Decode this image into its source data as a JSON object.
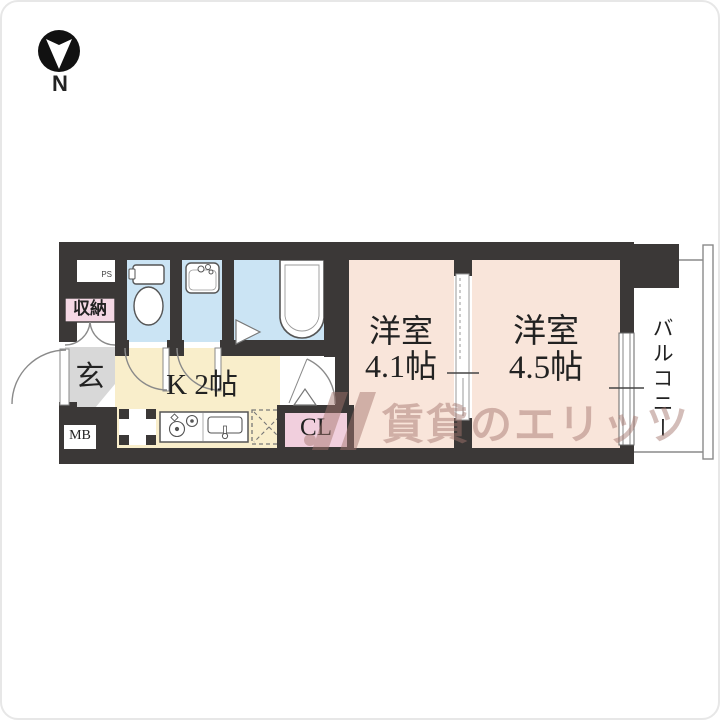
{
  "compass": {
    "north_label": "N"
  },
  "plan": {
    "rooms": {
      "pipe_space": "PS",
      "storage": "収納",
      "entrance": "玄",
      "meter_box": "MB",
      "kitchen": "K 2帖",
      "closet": "CL",
      "western_room_1": {
        "name": "洋室",
        "size": "4.1帖"
      },
      "western_room_2": {
        "name": "洋室",
        "size": "4.5帖"
      },
      "balcony": "バルコニー"
    },
    "colors": {
      "wall": "#3b3837",
      "floor_room": "#f9e5da",
      "floor_kitchen": "#f9eecb",
      "floor_wet": "#cbe4f4",
      "floor_entrance": "#d8d8d8",
      "label_pink_storage": "#f4d8e4",
      "label_pink_closet": "#f1cfdd",
      "balcony_floor": "#ffffff",
      "compass": "#111111",
      "watermark": "#a5766e"
    }
  },
  "watermark": {
    "text": "賃貸のエリッツ"
  }
}
